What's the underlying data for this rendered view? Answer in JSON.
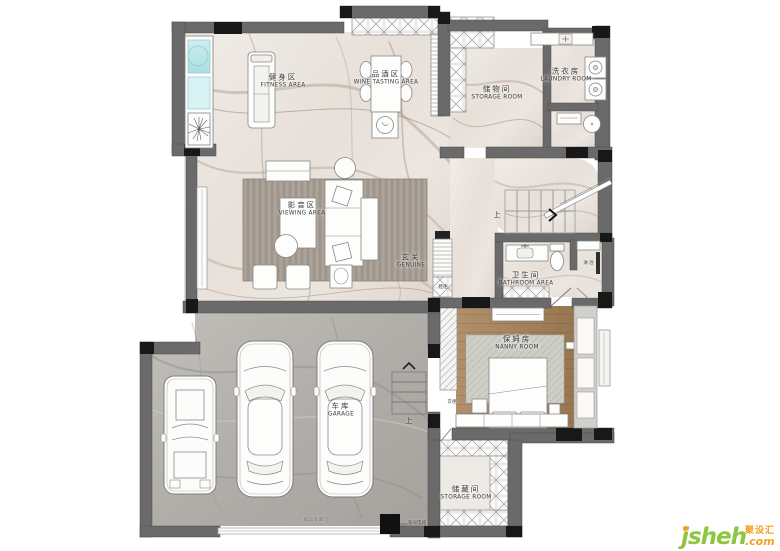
{
  "rooms": {
    "fitness": {
      "zh": "健身区",
      "en": "FITNESS AREA"
    },
    "wine_tasting": {
      "zh": "品酒区",
      "en": "WINE TASTING AREA"
    },
    "storage_top": {
      "zh": "储物间",
      "en": "STORAGE ROOM"
    },
    "laundry": {
      "zh": "洗衣房",
      "en": "LAUNDRY ROOM"
    },
    "viewing": {
      "zh": "影音区",
      "en": "VIEWING AREA"
    },
    "entrance": {
      "zh": "玄关",
      "en": "GENUINE"
    },
    "bathroom": {
      "zh": "卫生间",
      "en": "BATHROOM AREA"
    },
    "nanny": {
      "zh": "保姆房",
      "en": "NANNY ROOM"
    },
    "garage": {
      "zh": "车库",
      "en": "GARAGE"
    },
    "storage_bottom": {
      "zh": "储藏间",
      "en": "STORAGE ROOM"
    }
  },
  "annotations": {
    "stairs_up": "上",
    "garage_stairs_up": "上",
    "shower": "淋浴",
    "wardrobe": "衣柜",
    "shoe_cabinet": "鞋柜",
    "garage_door": "电动车库门",
    "power_box": "强弱电箱"
  },
  "logo": {
    "name": "jsheh",
    "tld": ".com",
    "cn": "聚设汇"
  },
  "colors": {
    "wall": "#6a6a6a",
    "column": "#181818",
    "marble": "#eae3dc",
    "garage_floor": "#b3afaa",
    "wood_floor": "#a8885f",
    "glass": "#c6ebee",
    "logo_green": "#8dc63f",
    "logo_orange": "#f6a01e"
  }
}
